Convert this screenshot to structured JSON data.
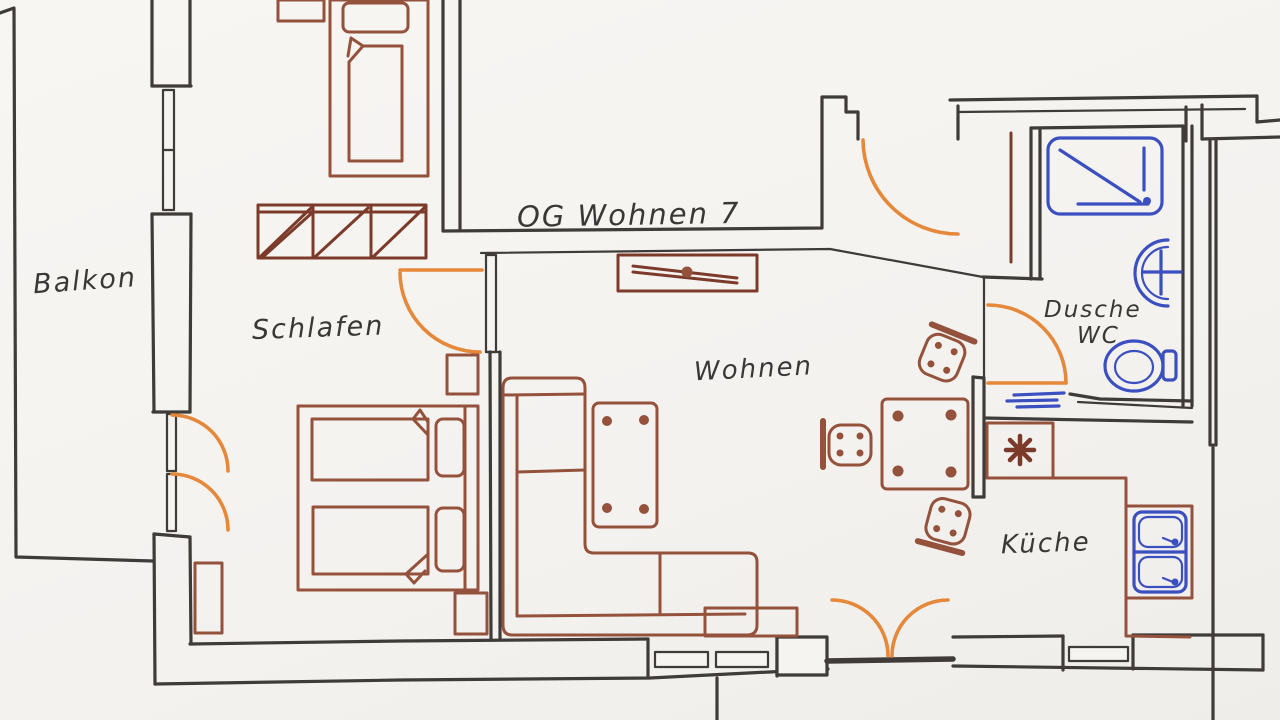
{
  "drawing": {
    "title": "OG Wohnen 7",
    "rooms": {
      "balkon": "Balkon",
      "schlafen": "Schlafen",
      "wohnen": "Wohnen",
      "dusche": "Dusche",
      "wc": "WC",
      "kueche": "Küche"
    },
    "colors": {
      "paper": "#f6f4f1",
      "wall": "#3e3b38",
      "furniture": "#94513c",
      "furniture_dark": "#7c3b2a",
      "door": "#e5883a",
      "fixture": "#3b4fc0",
      "text": "#3a3836"
    }
  }
}
